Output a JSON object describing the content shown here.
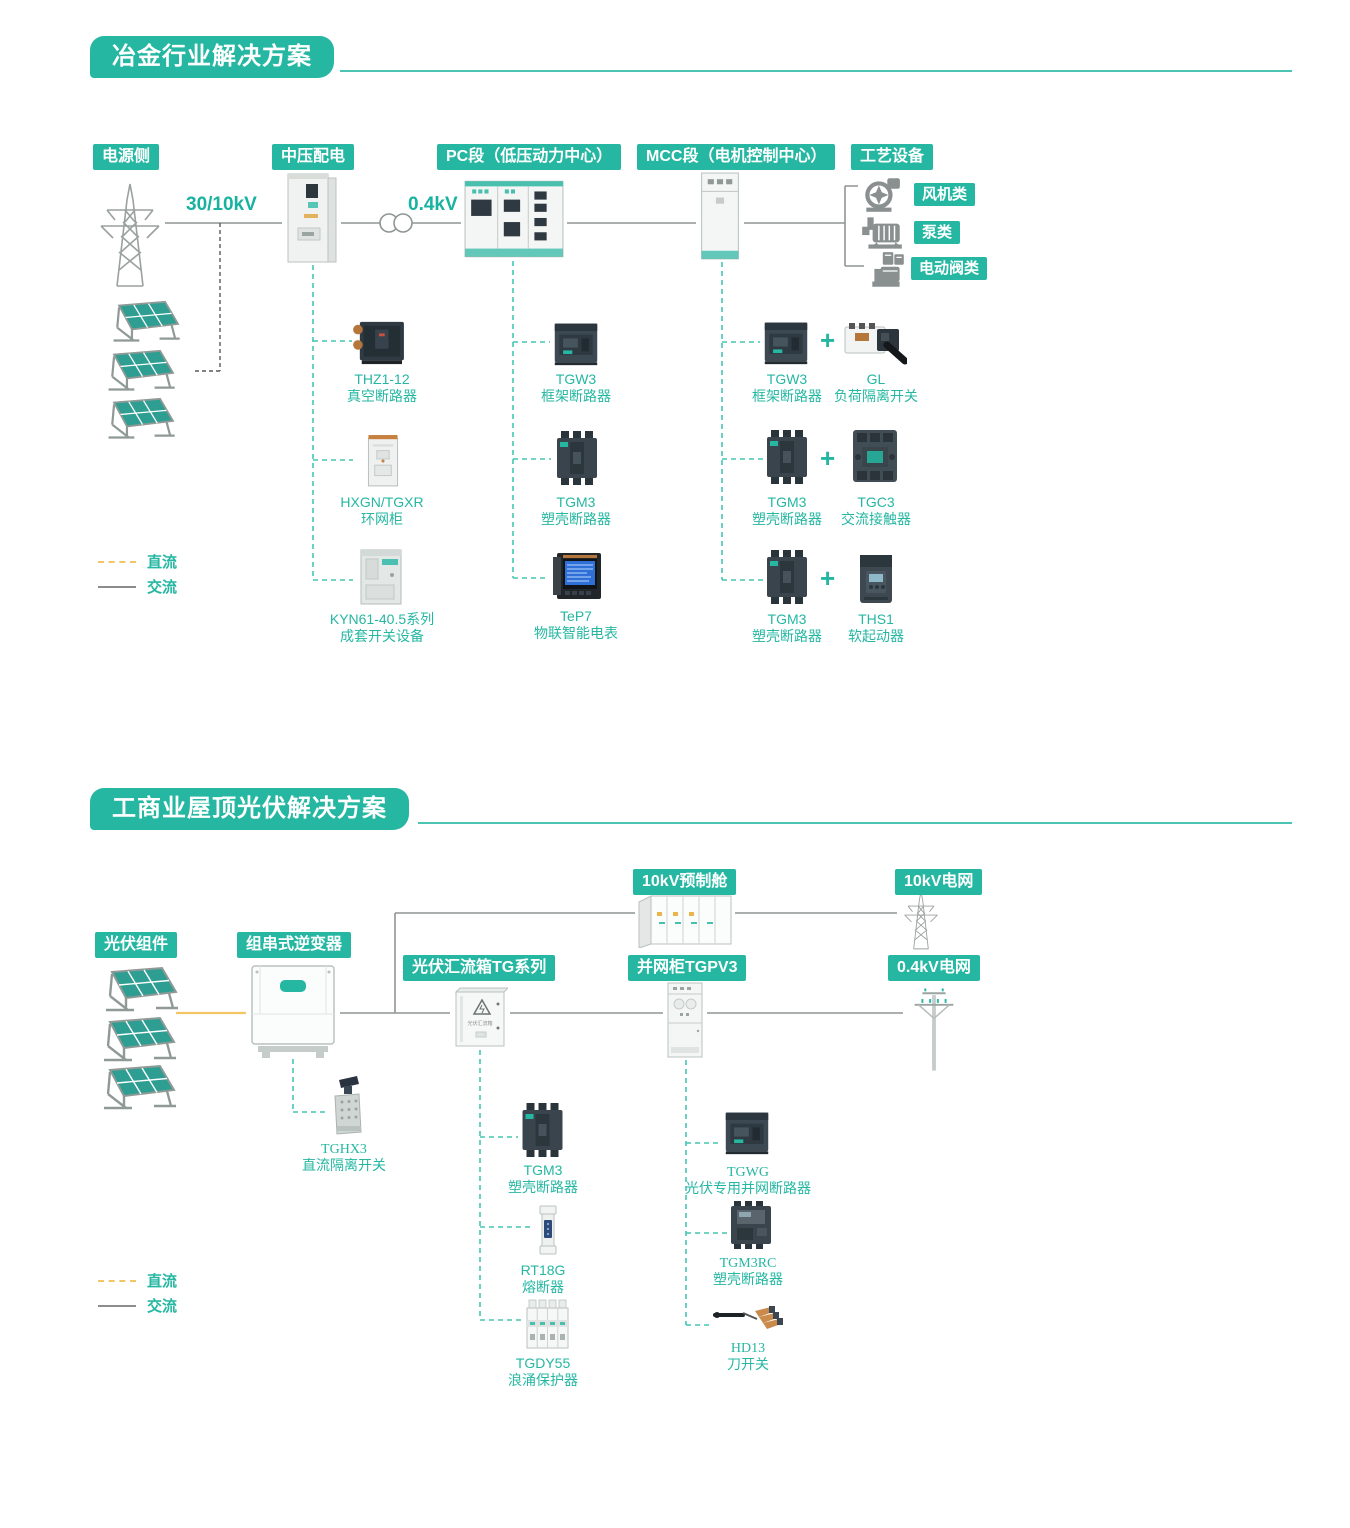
{
  "colors": {
    "teal": "#25b7a2",
    "line_gray": "#8f9694",
    "dc_yellow": "#f2c763",
    "teal_dash": "#45c6b3"
  },
  "s1": {
    "title": "冶金行业解决方案",
    "badges": {
      "power": "电源侧",
      "mv": "中压配电",
      "pc": "PC段（低压动力中心）",
      "mcc": "MCC段（电机控制中心）",
      "process": "工艺设备"
    },
    "voltages": {
      "v1": "30/10kV",
      "v2": "0.4kV"
    },
    "process_types": [
      "风机类",
      "泵类",
      "电动阀类"
    ],
    "plus": "+",
    "mv_products": [
      {
        "model": "THZ1-12",
        "desc": "真空断路器"
      },
      {
        "model": "HXGN/TGXR",
        "desc": "环网柜"
      },
      {
        "model": "KYN61-40.5系列",
        "desc": "成套开关设备"
      }
    ],
    "pc_products": [
      {
        "model": "TGW3",
        "desc": "框架断路器"
      },
      {
        "model": "TGM3",
        "desc": "塑壳断路器"
      },
      {
        "model": "TeP7",
        "desc": "物联智能电表"
      }
    ],
    "mcc_products": [
      {
        "a_model": "TGW3",
        "a_desc": "框架断路器",
        "b_model": "GL",
        "b_desc": "负荷隔离开关"
      },
      {
        "a_model": "TGM3",
        "a_desc": "塑壳断路器",
        "b_model": "TGC3",
        "b_desc": "交流接触器"
      },
      {
        "a_model": "TGM3",
        "a_desc": "塑壳断路器",
        "b_model": "THS1",
        "b_desc": "软起动器"
      }
    ],
    "legend": {
      "dc": "直流",
      "ac": "交流"
    }
  },
  "s2": {
    "title": "工商业屋顶光伏解决方案",
    "badges": {
      "pv": "光伏组件",
      "inverter": "组串式逆变器",
      "combiner": "光伏汇流箱TG系列",
      "gridcab": "并网柜TGPV3",
      "cabin": "10kV预制舱",
      "grid10": "10kV电网",
      "grid04": "0.4kV电网"
    },
    "combiner_box_label": "光伏汇流箱",
    "inv_product": {
      "model": "TGHX3",
      "desc": "直流隔离开关"
    },
    "combiner_products": [
      {
        "model": "TGM3",
        "desc": "塑壳断路器"
      },
      {
        "model": "RT18G",
        "desc": "熔断器"
      },
      {
        "model": "TGDY55",
        "desc": "浪涌保护器"
      }
    ],
    "gridcab_products": [
      {
        "model": "TGWG",
        "desc": "光伏专用并网断路器"
      },
      {
        "model": "TGM3RC",
        "desc": "塑壳断路器"
      },
      {
        "model": "HD13",
        "desc": "刀开关"
      }
    ],
    "legend": {
      "dc": "直流",
      "ac": "交流"
    }
  }
}
